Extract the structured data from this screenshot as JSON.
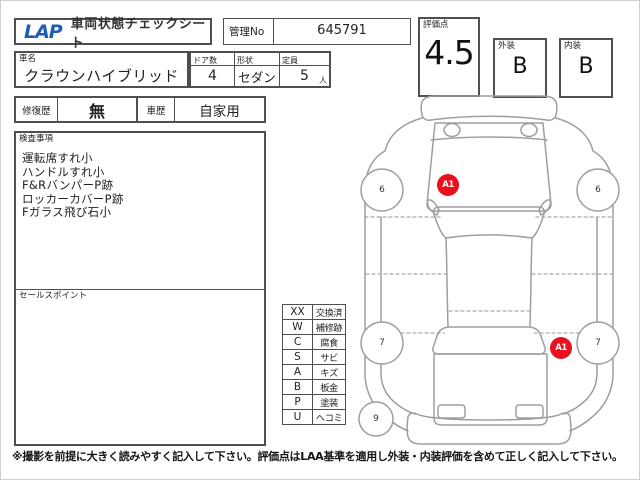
{
  "header": {
    "logo": "LAP",
    "title": "車両状態チェックシート",
    "manage_no_label": "管理No",
    "manage_no_value": "645791",
    "score_label": "評価点",
    "score_value": "4.5",
    "exterior_label": "外装",
    "exterior_value": "B",
    "interior_label": "内装",
    "interior_value": "B"
  },
  "vehicle": {
    "name_label": "車名",
    "name_value": "クラウンハイブリッド",
    "doors_label": "ドア数",
    "doors_value": "4",
    "body_label": "形状",
    "body_value": "セダン",
    "capacity_label": "定員",
    "capacity_value": "5",
    "capacity_unit": "人"
  },
  "history": {
    "repair_label": "修復歴",
    "repair_value": "無",
    "usage_label": "車歴",
    "usage_value": "自家用"
  },
  "inspection": {
    "title": "検査事項",
    "items": [
      "運転席すれ小",
      "ハンドルすれ小",
      "F&RバンパーP跡",
      "ロッカーカバーP跡",
      "Fガラス飛び石小"
    ],
    "sales_title": "セールスポイント"
  },
  "legend": {
    "rows": [
      {
        "code": "XX",
        "label": "交換済"
      },
      {
        "code": "W",
        "label": "補修跡"
      },
      {
        "code": "C",
        "label": "腐食"
      },
      {
        "code": "S",
        "label": "サビ"
      },
      {
        "code": "A",
        "label": "キズ"
      },
      {
        "code": "B",
        "label": "板金"
      },
      {
        "code": "P",
        "label": "塗装"
      },
      {
        "code": "U",
        "label": "ヘコミ"
      }
    ]
  },
  "diagram": {
    "wheel_labels": [
      "6",
      "6",
      "7",
      "7",
      "9"
    ],
    "markers": [
      {
        "label": "A1"
      },
      {
        "label": "A1"
      }
    ],
    "marker_color": "#e8121f",
    "outline_color": "#9e9e9e"
  },
  "footer": {
    "note": "※撮影を前提に大きく読みやすく記入して下さい。評価点はLAA基準を適用し外装・内装評価を含めて正しく記入して下さい。"
  },
  "colors": {
    "logo_blue": "#1c5db1"
  }
}
